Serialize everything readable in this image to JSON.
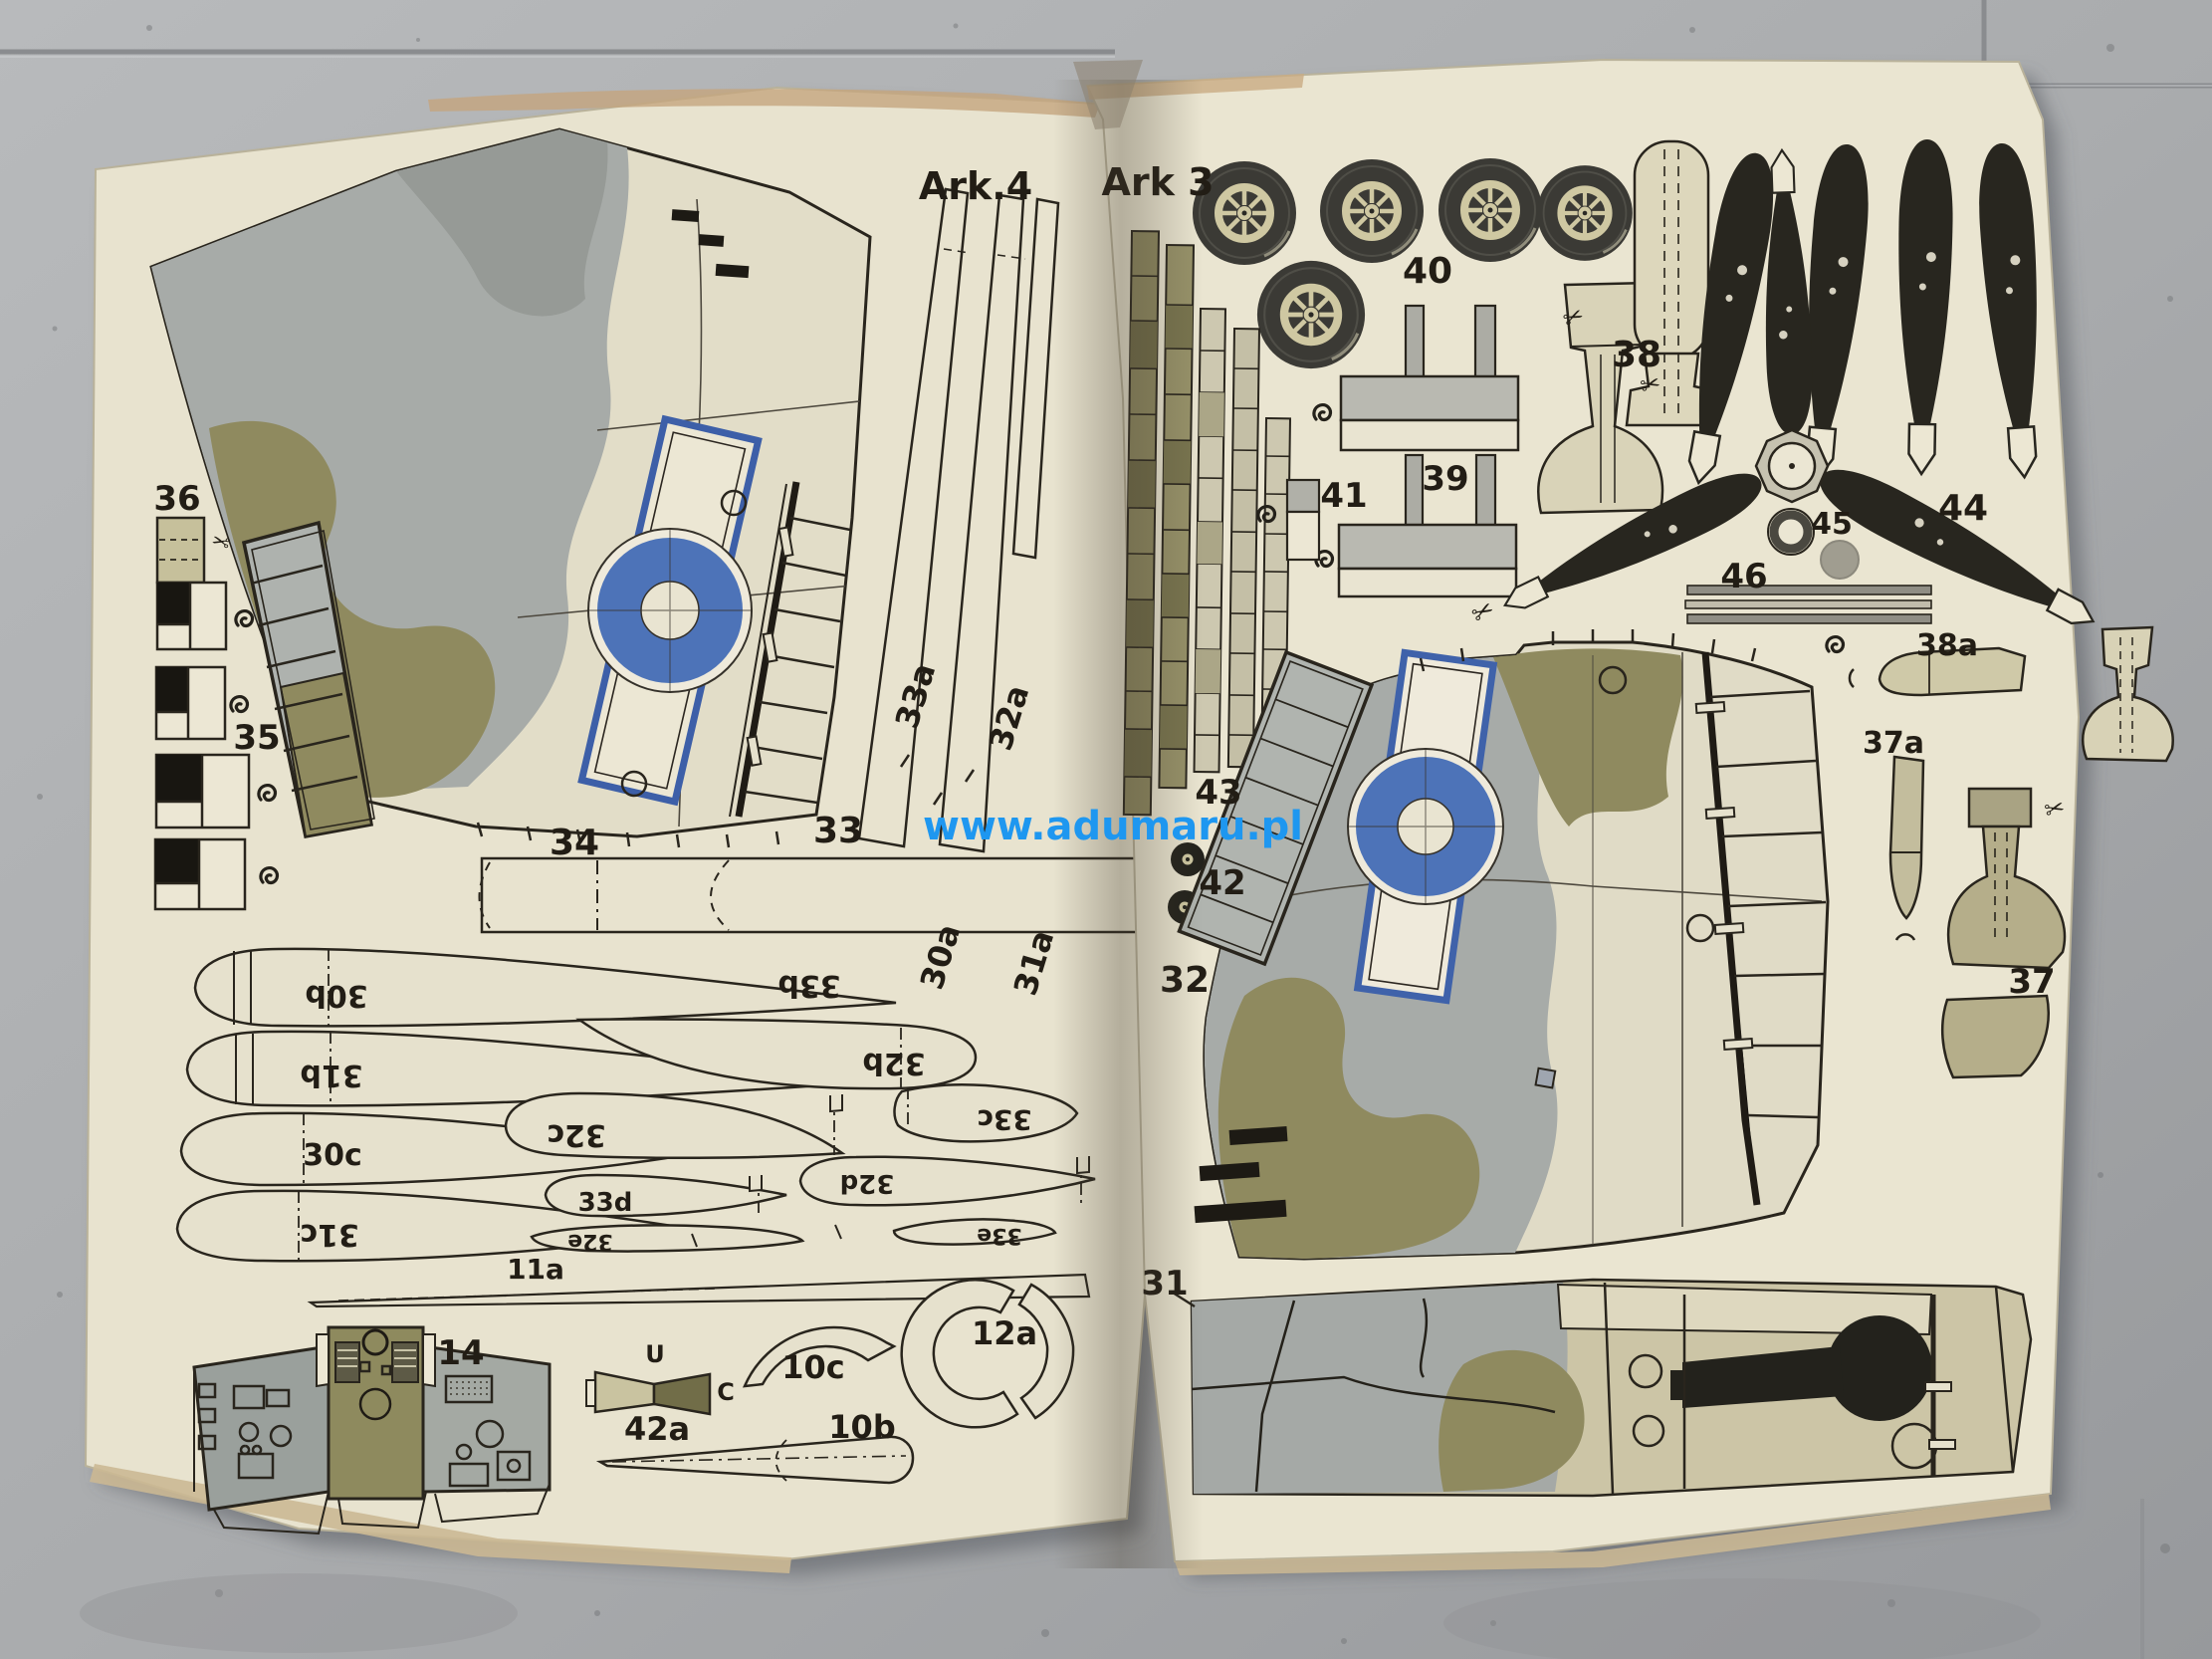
{
  "watermark": "www.adumaru.pl",
  "left": {
    "sheet_label": "Ark.4",
    "labels": [
      {
        "text": "36"
      },
      {
        "text": "35"
      },
      {
        "text": "34"
      },
      {
        "text": "33"
      },
      {
        "text": "33a"
      },
      {
        "text": "32a"
      },
      {
        "text": "30a"
      },
      {
        "text": "31a"
      },
      {
        "text": "33b"
      },
      {
        "text": "30b"
      },
      {
        "text": "31b"
      },
      {
        "text": "30c"
      },
      {
        "text": "31c"
      },
      {
        "text": "32b"
      },
      {
        "text": "32c"
      },
      {
        "text": "33c"
      },
      {
        "text": "33d"
      },
      {
        "text": "32d"
      },
      {
        "text": "32e"
      },
      {
        "text": "33e"
      },
      {
        "text": "11a"
      },
      {
        "text": "14"
      },
      {
        "text": "U"
      },
      {
        "text": "C"
      },
      {
        "text": "42a"
      },
      {
        "text": "10c"
      },
      {
        "text": "10b"
      },
      {
        "text": "12a"
      }
    ]
  },
  "right": {
    "sheet_label": "Ark 3",
    "labels": [
      {
        "text": "40"
      },
      {
        "text": "38"
      },
      {
        "text": "39"
      },
      {
        "text": "41"
      },
      {
        "text": "43"
      },
      {
        "text": "42"
      },
      {
        "text": "32"
      },
      {
        "text": "44"
      },
      {
        "text": "45"
      },
      {
        "text": "46"
      },
      {
        "text": "38a"
      },
      {
        "text": "37a"
      },
      {
        "text": "37"
      },
      {
        "text": "31"
      }
    ]
  },
  "symbols": {
    "scissors": "✂"
  },
  "colors": {
    "paper": "#e8e3cf",
    "camo_gray": "#a7aba8",
    "camo_olive": "#8f8a5f",
    "roundel_blue": "#4d73b8",
    "tire_black": "#3b3a35",
    "ink": "#29251d",
    "watermark_blue": "#1e97f0",
    "floor_gray": "#aeb0b3"
  }
}
